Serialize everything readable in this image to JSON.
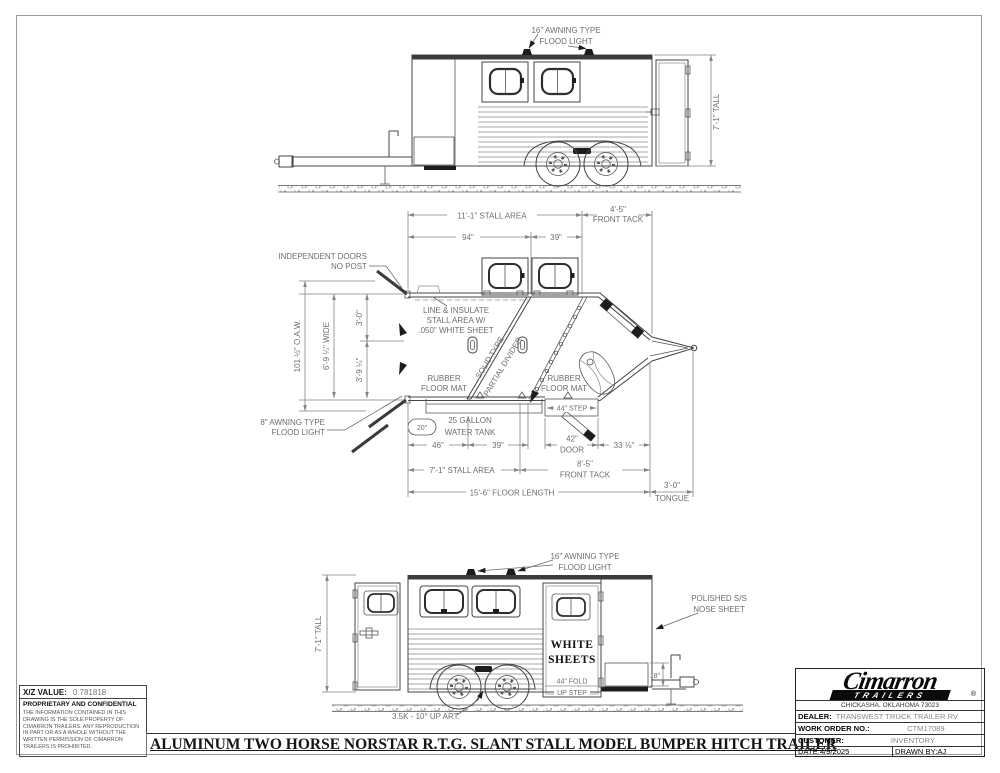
{
  "meta": {
    "paper_color": "#ffffff",
    "line_color": "#454545",
    "dim_color": "#6e6e6e"
  },
  "top_view": {
    "flood_light_1": "16\" AWNING TYPE",
    "flood_light_2": "FLOOD LIGHT",
    "tall": "7'-1\" TALL"
  },
  "plan": {
    "stall_area_top": "11'-1\" STALL AREA",
    "front_tack_1": "4'-5\"",
    "front_tack_2": "FRONT TACK",
    "d94": "94\"",
    "d39": "39\"",
    "indep_1": "INDEPENDENT DOORS",
    "indep_2": "NO POST",
    "oaw": "101 ½\" O.A.W.",
    "wide": "6'-9 ¼\" WIDE",
    "d30": "3'-0\"",
    "d394": "3'-9 ¼\"",
    "insulate_1": "LINE & INSULATE",
    "insulate_2": "STALL AREA W/",
    "insulate_3": ".050\" WHITE SHEET",
    "divider_1": "SOLID TYPE",
    "divider_2": "PARTIAL DIVIDER",
    "mat_1a": "RUBBER",
    "mat_1b": "FLOOR MAT",
    "mat_2a": "RUBBER",
    "mat_2b": "FLOOR MAT",
    "awning_1": "8\" AWNING TYPE",
    "awning_2": "FLOOD LIGHT",
    "bubble_20": "20\"",
    "tank_1": "25 GALLON",
    "tank_2": "WATER TANK",
    "d46": "46\"",
    "d39b": "39\"",
    "step_44": "44\" STEP",
    "door_1": "42\"",
    "door_2": "DOOR",
    "d338": "33 ⅛\"",
    "stall_area_bottom": "7'-1\" STALL AREA",
    "tack_b1": "8'-5\"",
    "tack_b2": "FRONT TACK",
    "floor_length": "15'-6\" FLOOR LENGTH",
    "tongue_1": "3'-0\"",
    "tongue_2": "TONGUE"
  },
  "bottom_view": {
    "flood_1": "16\" AWNING TYPE",
    "flood_2": "FLOOD LIGHT",
    "polished_1": "POLISHED S/S",
    "polished_2": "NOSE SHEET",
    "tall": "7'-1\" TALL",
    "white_1": "WHITE",
    "white_2": "SHEETS",
    "fold_1": "44\" FOLD",
    "fold_2": "UP STEP",
    "d18": "18\"",
    "axle_note": "3.5K - 10° UP ART."
  },
  "info": {
    "xz_label": "X/Z VALUE:",
    "xz_value": "0.781818",
    "prop_title": "PROPRIETARY AND CONFIDENTIAL",
    "prop_body": "THE INFORMATION CONTAINED IN THIS DRAWING IS THE SOLE PROPERTY OF CIMARRON TRAILERS.  ANY REPRODUCTION IN PART OR AS A WHOLE WITHOUT THE WRITTEN PERMISSION OF CIMARRON TRAILERS IS PROHIBITED."
  },
  "title_block": {
    "brand": "Cimarron",
    "brand_sub": "TRAILERS",
    "reg": "®",
    "address": "CHICKASHA, OKLAHOMA 73023",
    "dealer_label": "DEALER:",
    "dealer_value": "TRANSWEST TRUCK TRAILER RV",
    "wo_label": "WORK ORDER NO.:",
    "wo_value": "CTM17089",
    "customer_label": "CUSTOMER:",
    "customer_value": "INVENTORY",
    "date_label": "DATE:",
    "date_value": "4/9/2025",
    "drawn_label": "DRAWN BY:",
    "drawn_value": "AJ"
  },
  "footer": {
    "title": "ALUMINUM TWO HORSE NORSTAR R.T.G. SLANT STALL MODEL BUMPER HITCH TRAILER"
  }
}
